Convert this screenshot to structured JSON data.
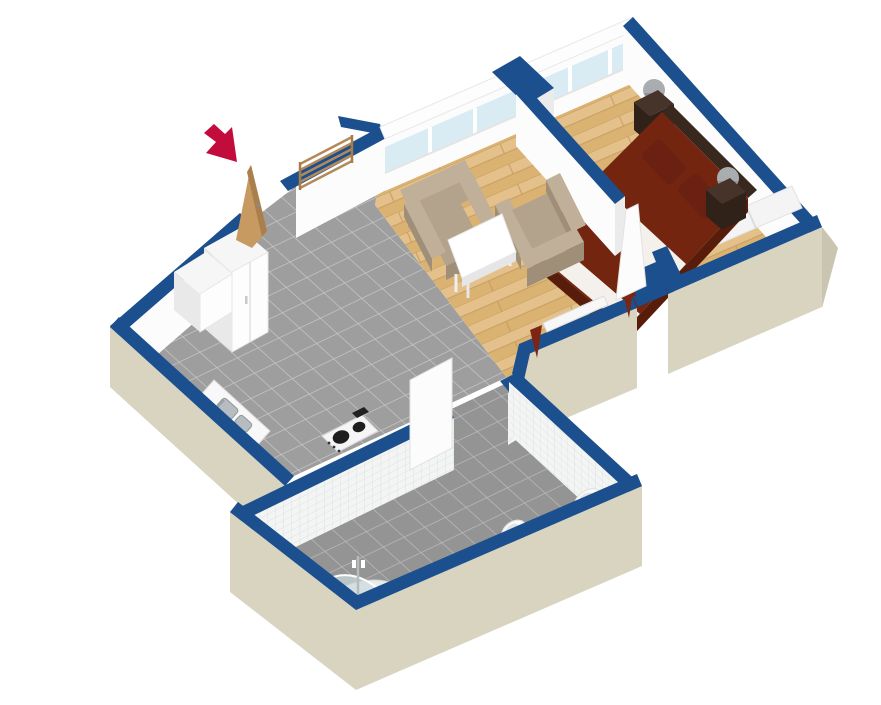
{
  "scene": {
    "type": "3d-floor-plan-isometric",
    "background": "#ffffff",
    "rooms": [
      {
        "id": "kitchen-hall",
        "floor": "gray-tile",
        "furniture": [
          "entrance-door",
          "entry-wardrobe-low",
          "entry-wardrobe-tall",
          "coat-rack",
          "kitchen-counter-with-sink",
          "stove"
        ]
      },
      {
        "id": "living-room",
        "floor": "oak-parquet",
        "furniture": [
          "armchair",
          "armchair",
          "coffee-table",
          "window-radiator",
          "red-curtains"
        ]
      },
      {
        "id": "bedroom",
        "floor": "oak-parquet",
        "furniture": [
          "double-bed",
          "headboard",
          "nightstand-left",
          "nightstand-right",
          "table-lamp-left",
          "table-lamp-right",
          "wardrobe-panels",
          "room-door"
        ]
      },
      {
        "id": "bathroom",
        "floor": "gray-tile",
        "walls": "white-tile",
        "furniture": [
          "corner-shower",
          "toilet",
          "washbasin",
          "room-door"
        ]
      }
    ],
    "markers": [
      {
        "id": "entrance-arrow",
        "meaning": "entrance",
        "color": "#c20d3c"
      }
    ]
  },
  "palette": {
    "background": "#ffffff",
    "wallTop": "#1b4f8d",
    "wallExterior": "#d8d4c0",
    "wallExteriorShade": "#c9c5b0",
    "wallInterior": "#fcfcfc",
    "wallInteriorShade": "#ebebeb",
    "tileFloor": "#9e9e9e",
    "tileGrout": "#c8c8c8",
    "wood": "#e4c08a",
    "woodAlt": "#dab272",
    "woodSeam": "#c69c60",
    "wallTile": "#f3f5f4",
    "wallTileLine": "#d6dbda",
    "glass": "#d9ecf4",
    "bedSpread": "#73250f",
    "bedShade": "#581c0a",
    "bedding": "#f4f1ec",
    "pillow": "#6a2111",
    "headboard": "#38281e",
    "nightstand": "#46332a",
    "nightstandShade": "#302219",
    "lamp": "#a9adb0",
    "armchair": "#b3a28c",
    "armchairLight": "#c0b09a",
    "armchairShade": "#9f8e78",
    "table": "#ffffff",
    "tableShade": "#e6e6e6",
    "counter": "#f8f8f8",
    "counterShade": "#e3e3e3",
    "sink": "#b7bcc0",
    "sinkDark": "#8f979c",
    "stove": "#f5f5f5",
    "burner": "#1e1e1e",
    "doorWood": "#c79a62",
    "doorWoodDark": "#aa7f4b",
    "coatRack": "#b4895a",
    "curtain": "#7e2413",
    "fixture": "#fbfbfb",
    "fixtureShade": "#e0e4e4",
    "showerGlass": "#ccd9dc",
    "arrow": "#c20d3c"
  }
}
